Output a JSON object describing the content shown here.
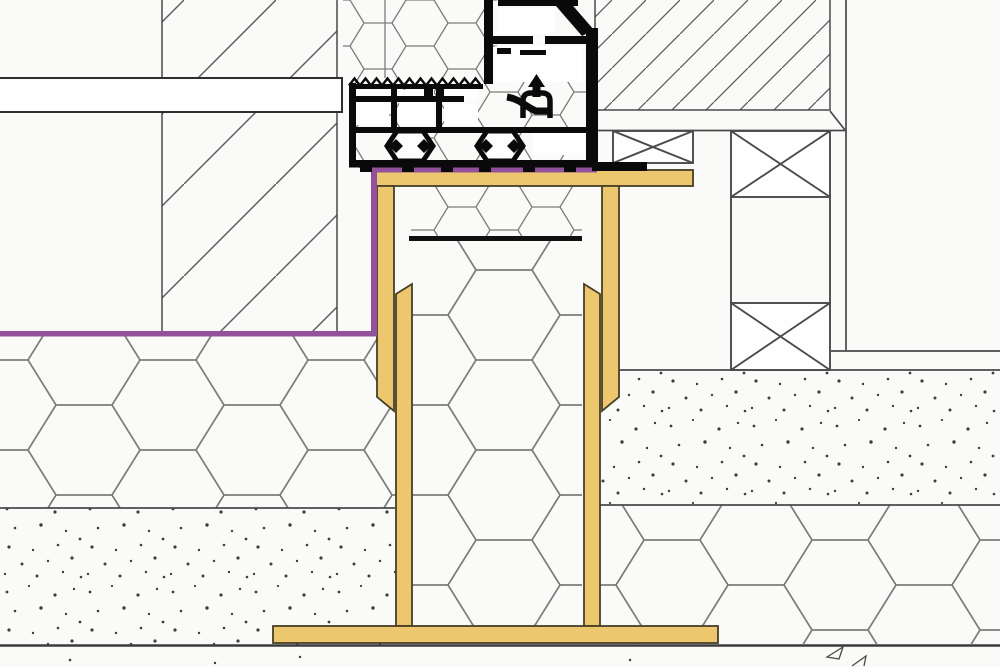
{
  "drawing": {
    "background": "#fafbf8",
    "steel_fill": "#edc76e",
    "steel_outline": "#473f27",
    "membrane_fill": "#93519b",
    "profile_fill": "#0a0a0a",
    "chamber_fill": "#fdfefd",
    "line_dark": "#303030",
    "line_medium": "#4a4a4a",
    "hatch_line": "#5c5c5c",
    "hex_line": "#7c7c7c",
    "stipple_dot": "#3e3e3e"
  }
}
